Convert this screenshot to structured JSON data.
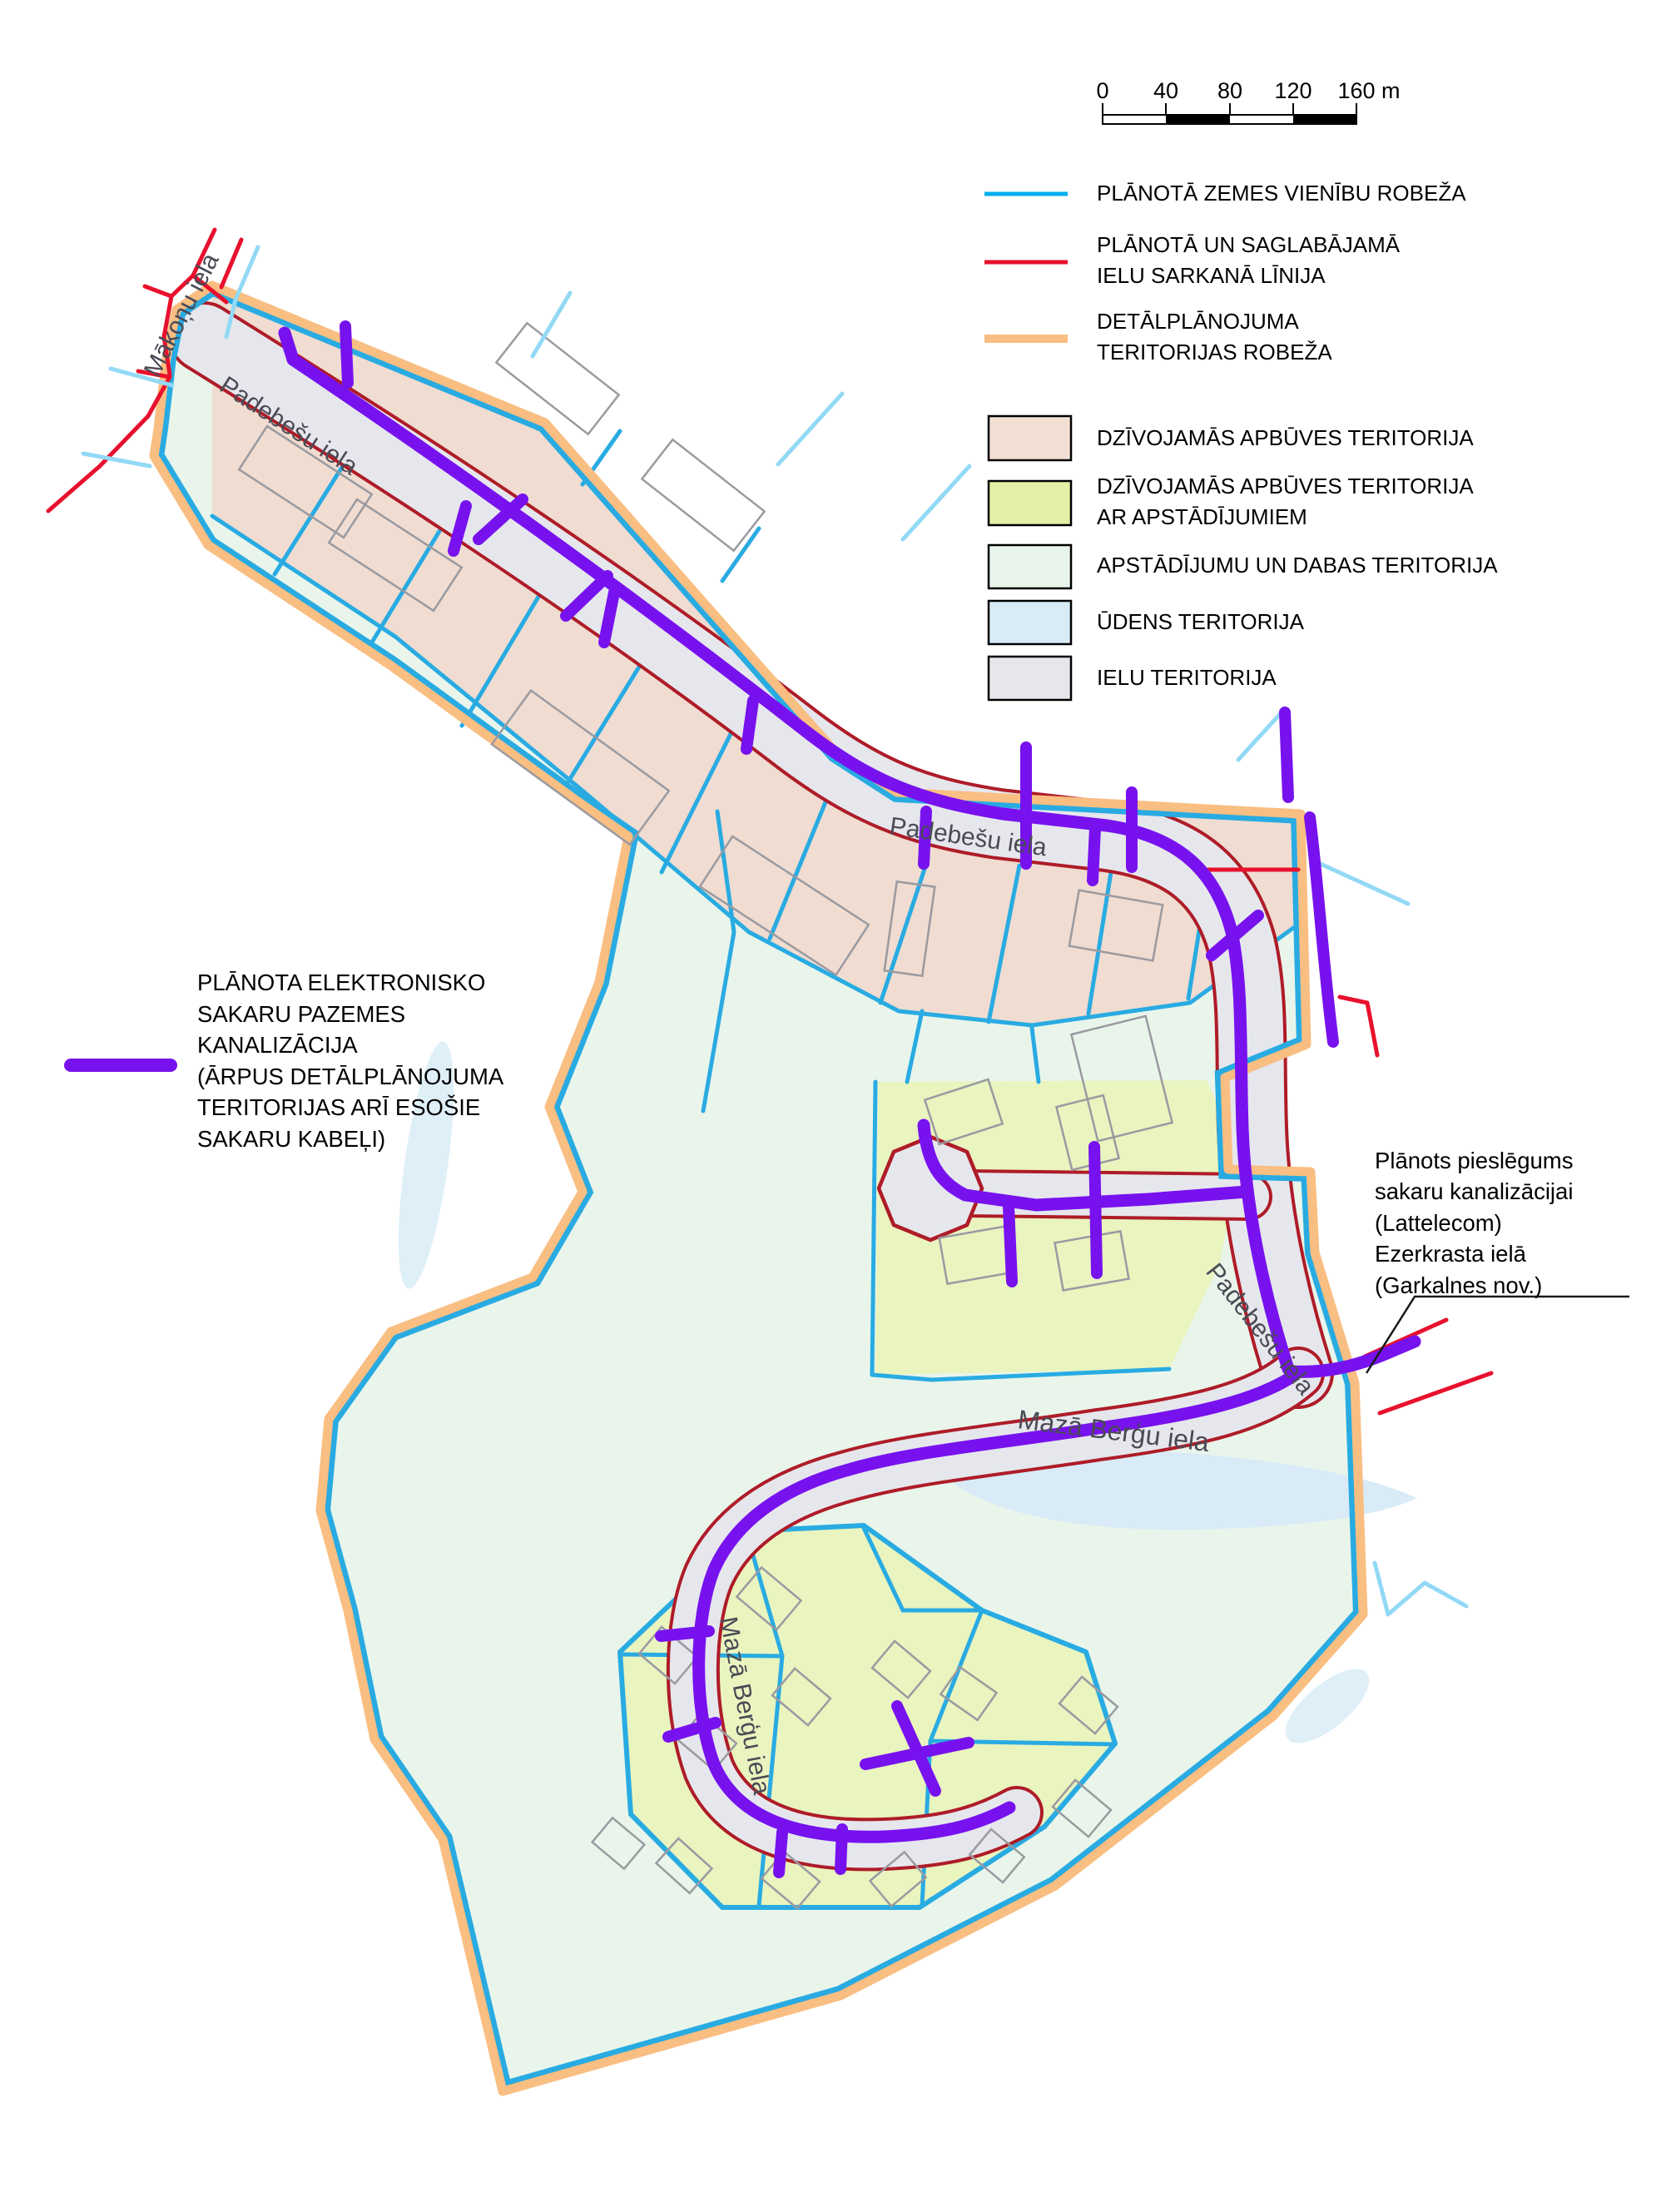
{
  "scale_bar": {
    "ticks": [
      "0",
      "40",
      "80",
      "120",
      "160 m"
    ]
  },
  "legend_lines": [
    {
      "name": "planned-land-unit-boundary",
      "color": "#00AEEF",
      "lines": [
        "PLĀNOTĀ ZEMES VIENĪBU ROBEŽA",
        ""
      ]
    },
    {
      "name": "street-red-line",
      "color": "#E8112D",
      "lines": [
        "PLĀNOTĀ UN SAGLABĀJAMĀ",
        "IELU SARKANĀ LĪNIJA"
      ]
    },
    {
      "name": "detailplan-territory-boundary",
      "color": "#F9BE82",
      "lines": [
        "DETĀLPLĀNOJUMA",
        "TERITORIJAS ROBEŽA"
      ]
    }
  ],
  "legend_fills": [
    {
      "name": "residential-territory",
      "color": "#F2DFD4",
      "lines": [
        "DZĪVOJAMĀS APBŪVES TERITORIJA",
        ""
      ]
    },
    {
      "name": "residential-territory-with-greenery",
      "color": "#E2F1A6",
      "lines": [
        "DZĪVOJAMĀS APBŪVES TERITORIJA",
        "AR APSTĀDĪJUMIEM"
      ]
    },
    {
      "name": "greenery-and-nature-territory",
      "color": "#E9F5EB",
      "lines": [
        "APSTĀDĪJUMU UN DABAS TERITORIJA",
        ""
      ]
    },
    {
      "name": "water-territory",
      "color": "#D8EBF7",
      "lines": [
        "ŪDENS TERITORIJA",
        ""
      ]
    },
    {
      "name": "street-territory",
      "color": "#E6E7ED",
      "lines": [
        "IELU TERITORIJA",
        ""
      ]
    }
  ],
  "purple_note": {
    "color": "#7712EE",
    "lines": [
      "PLĀNOTA ELEKTRONISKO",
      "SAKARU PAZEMES",
      "KANALIZĀCIJA",
      "(ĀRPUS DETĀLPLĀNOJUMA",
      "TERITORIJAS ARĪ ESOŠIE",
      "SAKARU KABEĻI)"
    ]
  },
  "connection_note": {
    "lines": [
      "Plānots pieslēgums",
      "sakaru kanalizācijai",
      "(Lattelecom)",
      "Ezerkrasta ielā",
      "(Garkalnes nov.)"
    ]
  },
  "street_labels": {
    "makonu": "Mākoņu iela",
    "padebesu": "Padebešu iela",
    "maza_bergu": "Mazā Berģu iela"
  },
  "map_colors": {
    "boundary_orange": "#F9BE82",
    "parcel_cyan": "#29ABE2",
    "light_cyan": "#92D9F5",
    "bright_red": "#E8112D",
    "street_edge_dark_red": "#AE1C28",
    "street_gray": "#E6E7ED",
    "residential_pink": "#F0DCD1",
    "residential_green": "#E9F4BF",
    "nature_mint": "#E9F5EB",
    "water_blue": "#D8EBF7",
    "conduit_purple": "#7712EE",
    "building_outline": "#9A9AA0"
  }
}
